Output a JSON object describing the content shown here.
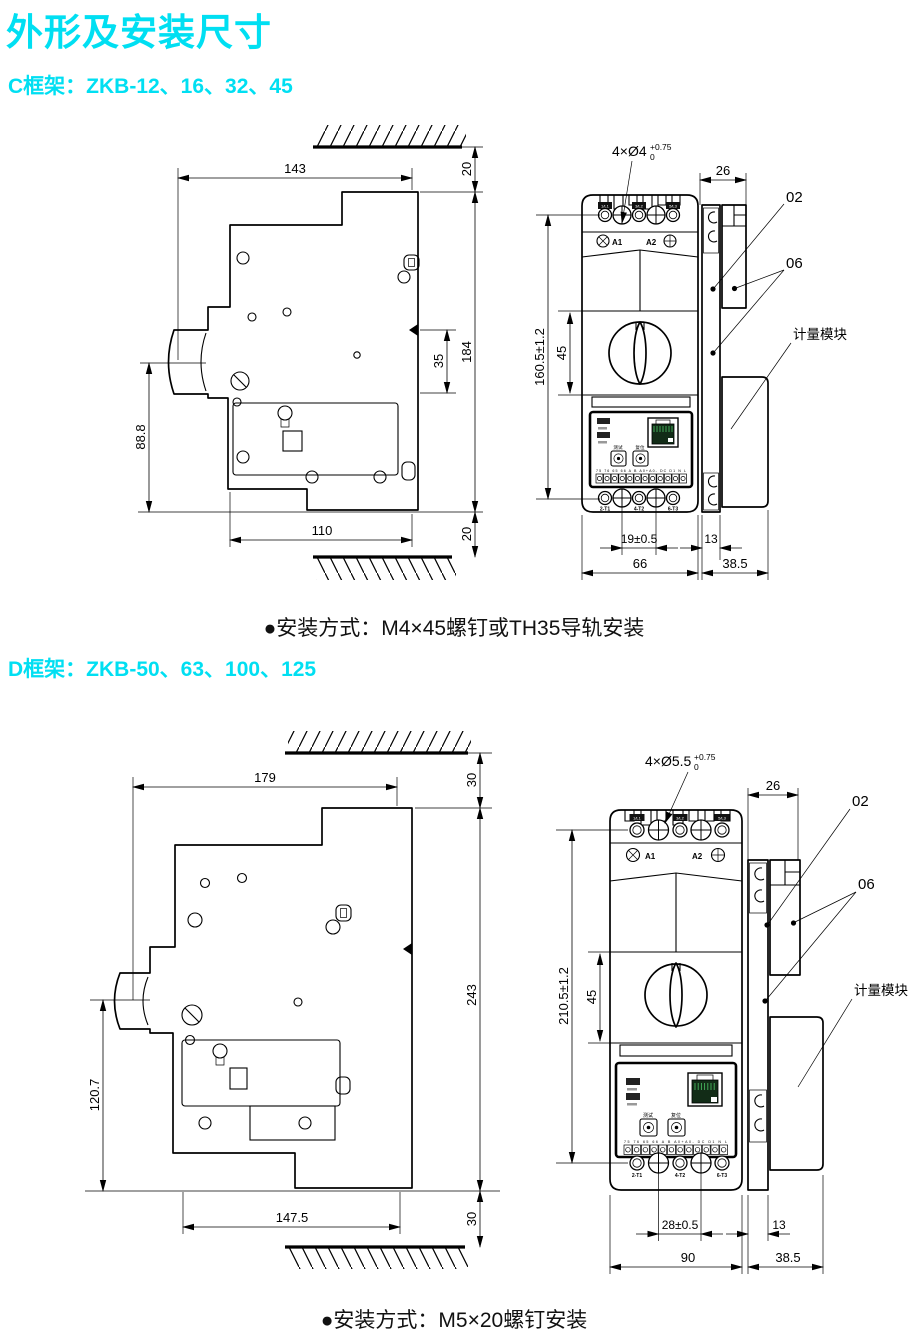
{
  "page": {
    "title": "外形及安装尺寸",
    "accent_color": "#00dff2"
  },
  "c": {
    "heading": "C框架：ZKB-12、16、32、45",
    "note": "●安装方式：M4×45螺钉或TH35导轨安装",
    "side": {
      "w_top": "143",
      "gap_top": "20",
      "h_total": "184",
      "rail_notch": "35",
      "h_lower": "88.8",
      "w_bottom": "110",
      "gap_bottom": "20"
    },
    "front": {
      "holes": "4×Ø4",
      "tol_up": "+0.75",
      "tol_dn": "0",
      "offset_26": "26",
      "h_mount": "160.5±1.2",
      "h_handle": "45",
      "span_holes": "19±0.5",
      "rail_w": "13",
      "w_body": "66",
      "w_module": "38.5",
      "co_02": "02",
      "co_06": "06",
      "metering": "计量模块",
      "a1": "A1",
      "a2": "A2",
      "l1": "1/L1",
      "l2": "3/L2",
      "l3": "5/L3",
      "t1": "2-T1",
      "t2": "4-T2",
      "t3": "6-T3",
      "btn_test": "测试",
      "btn_reset": "复位",
      "strip": "75 76 65 66 A B A0+A0- DC D1 N L"
    }
  },
  "d": {
    "heading": "D框架：ZKB-50、63、100、125",
    "note": "●安装方式：M5×20螺钉安装",
    "side": {
      "w_top": "179",
      "gap_top": "30",
      "h_total": "243",
      "h_lower": "120.7",
      "w_bottom": "147.5",
      "gap_bottom": "30"
    },
    "front": {
      "holes": "4×Ø5.5",
      "tol_up": "+0.75",
      "tol_dn": "0",
      "offset_26": "26",
      "h_mount": "210.5±1.2",
      "h_handle": "45",
      "span_holes": "28±0.5",
      "rail_w": "13",
      "w_body": "90",
      "w_module": "38.5",
      "co_02": "02",
      "co_06": "06",
      "metering": "计量模块",
      "a1": "A1",
      "a2": "A2",
      "l1": "1/L1",
      "l2": "3/L2",
      "l3": "5/L3",
      "t1": "2-T1",
      "t2": "4-T2",
      "t3": "6-T3",
      "btn_test": "测试",
      "btn_reset": "复位",
      "strip": "75 76 65 66 A B A0+A0- DC D1 N L"
    }
  }
}
